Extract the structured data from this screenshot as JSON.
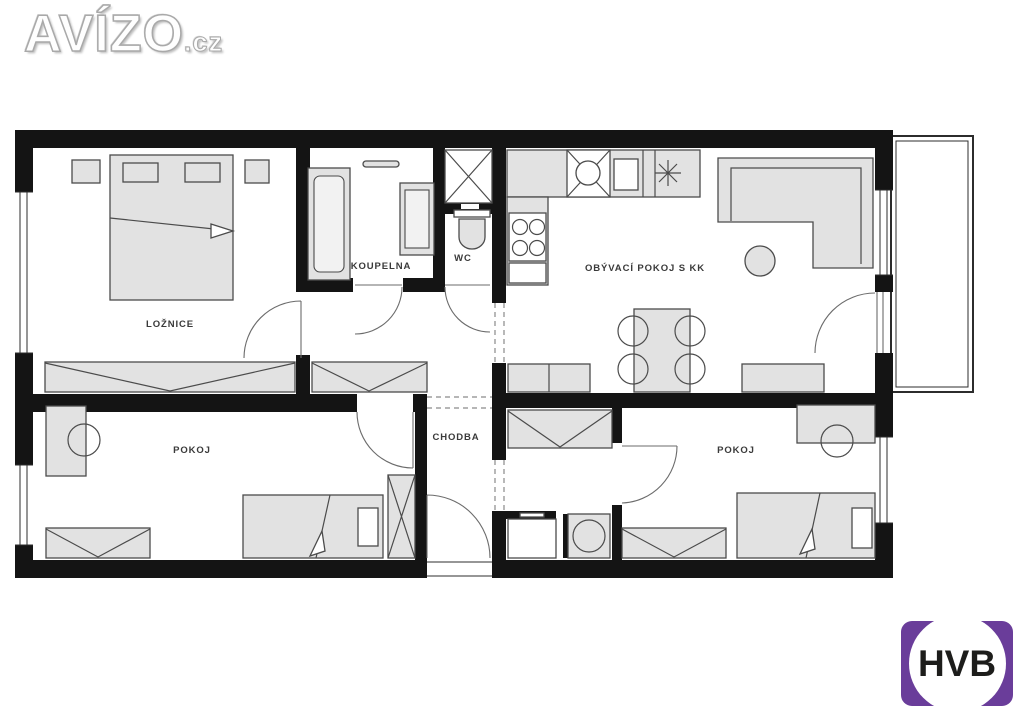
{
  "branding": {
    "site_name": "AVÍZO",
    "site_tld": ".cz",
    "agency_name": "HVB"
  },
  "floor_plan": {
    "rooms": {
      "bedroom": {
        "label": "LOŽNICE"
      },
      "bathroom": {
        "label": "KOUPELNA"
      },
      "wc": {
        "label": "WC"
      },
      "living_room": {
        "label": "OBÝVACÍ POKOJ S KK"
      },
      "hallway": {
        "label": "CHODBA"
      },
      "room_left": {
        "label": "POKOJ"
      },
      "room_right": {
        "label": "POKOJ"
      }
    }
  },
  "colors": {
    "wall": "#141414",
    "furniture_fill": "#e2e2e2",
    "furniture_stroke": "#4b4b4b",
    "line": "#2c2c2c",
    "label": "#3a3a3a",
    "hvb_purple": "#6a3d9a",
    "hvb_text": "#1d1d1b"
  }
}
